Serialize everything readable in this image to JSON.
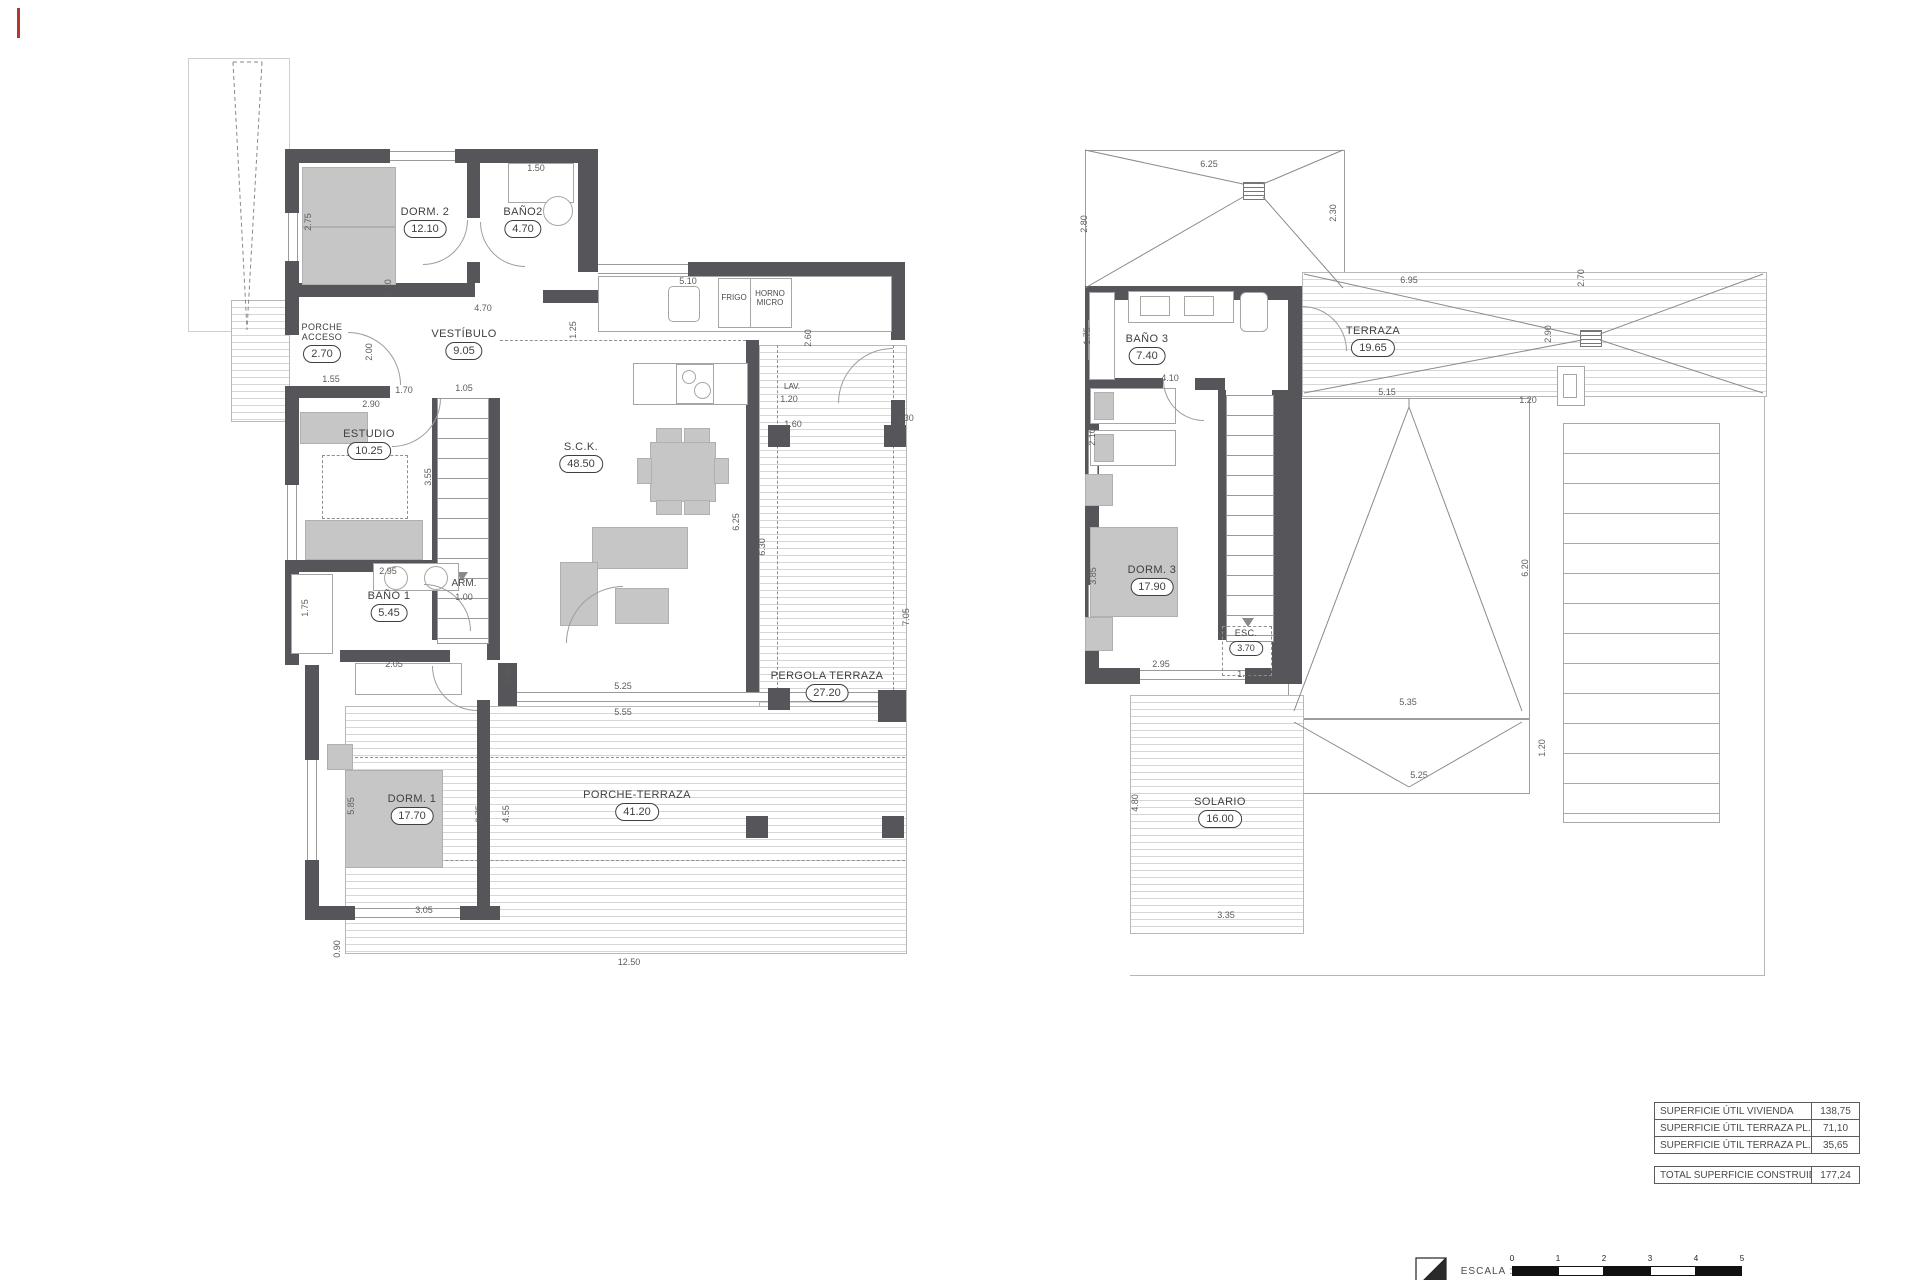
{
  "ground_floor": {
    "rooms": [
      {
        "name": "DORM. 2",
        "area": "12.10"
      },
      {
        "name": "BAÑO2",
        "area": "4.70"
      },
      {
        "name": "PORCHE ACCESO",
        "area": "2.70"
      },
      {
        "name": "VESTÍBULO",
        "area": "9.05"
      },
      {
        "name": "ESTUDIO",
        "area": "10.25"
      },
      {
        "name": "S.C.K.",
        "area": "48.50"
      },
      {
        "name": "BAÑO 1",
        "area": "5.45"
      },
      {
        "name": "DORM. 1",
        "area": "17.70"
      },
      {
        "name": "PERGOLA TERRAZA",
        "area": "27.20"
      },
      {
        "name": "PORCHE-TERRAZA",
        "area": "41.20"
      }
    ],
    "fixtures": {
      "fridge": "FRIGO",
      "oven": "HORNO\nMICRO",
      "laundry": "LAV.",
      "wardrobe": "ARM."
    },
    "dims": [
      "2.75",
      "1.50",
      "0.20",
      "4.70",
      "5.10",
      "1.25",
      "2.60",
      "1.20",
      "1.60",
      "1.30",
      "1.55",
      "1.70",
      "2.90",
      "2.00",
      "1.05",
      "3.55",
      "2.95",
      "1.75",
      "2.05",
      "0.55",
      "5.25",
      "5.55",
      "6.25",
      "6.30",
      "7.05",
      "5.85",
      "6.75",
      "4.55",
      "3.05",
      "0.90",
      "12.50",
      "1.00"
    ]
  },
  "upper_floor": {
    "rooms": [
      {
        "name": "BAÑO 3",
        "area": "7.40"
      },
      {
        "name": "TERRAZA",
        "area": "19.65"
      },
      {
        "name": "DORM. 3",
        "area": "17.90"
      },
      {
        "name": "ESC.",
        "area": "3.70"
      },
      {
        "name": "SOLARIO",
        "area": "16.00"
      }
    ],
    "dims": [
      "6.25",
      "2.80",
      "2.30",
      "6.95",
      "2.90",
      "2.70",
      "5.15",
      "1.20",
      "1.75",
      "4.10",
      "2.10",
      "3.85",
      "2.95",
      "1.05",
      "6.20",
      "5.35",
      "5.25",
      "1.20",
      "4.80",
      "3.35"
    ]
  },
  "summary_table": {
    "rows": [
      {
        "label": "SUPERFICIE ÚTIL VIVIENDA",
        "value": "138,75"
      },
      {
        "label": "SUPERFICIE ÚTIL TERRAZA PL. BAJA",
        "value": "71,10"
      },
      {
        "label": "SUPERFICIE ÚTIL TERRAZA PL. ALTA",
        "value": "35,65"
      }
    ],
    "total": {
      "label": "TOTAL SUPERFICIE CONSTRUIDA",
      "value": "177,24"
    }
  },
  "scale_bar": {
    "label": "ESCALA :",
    "north": "N",
    "ticks": [
      "0",
      "1",
      "2",
      "3",
      "4",
      "5"
    ]
  }
}
